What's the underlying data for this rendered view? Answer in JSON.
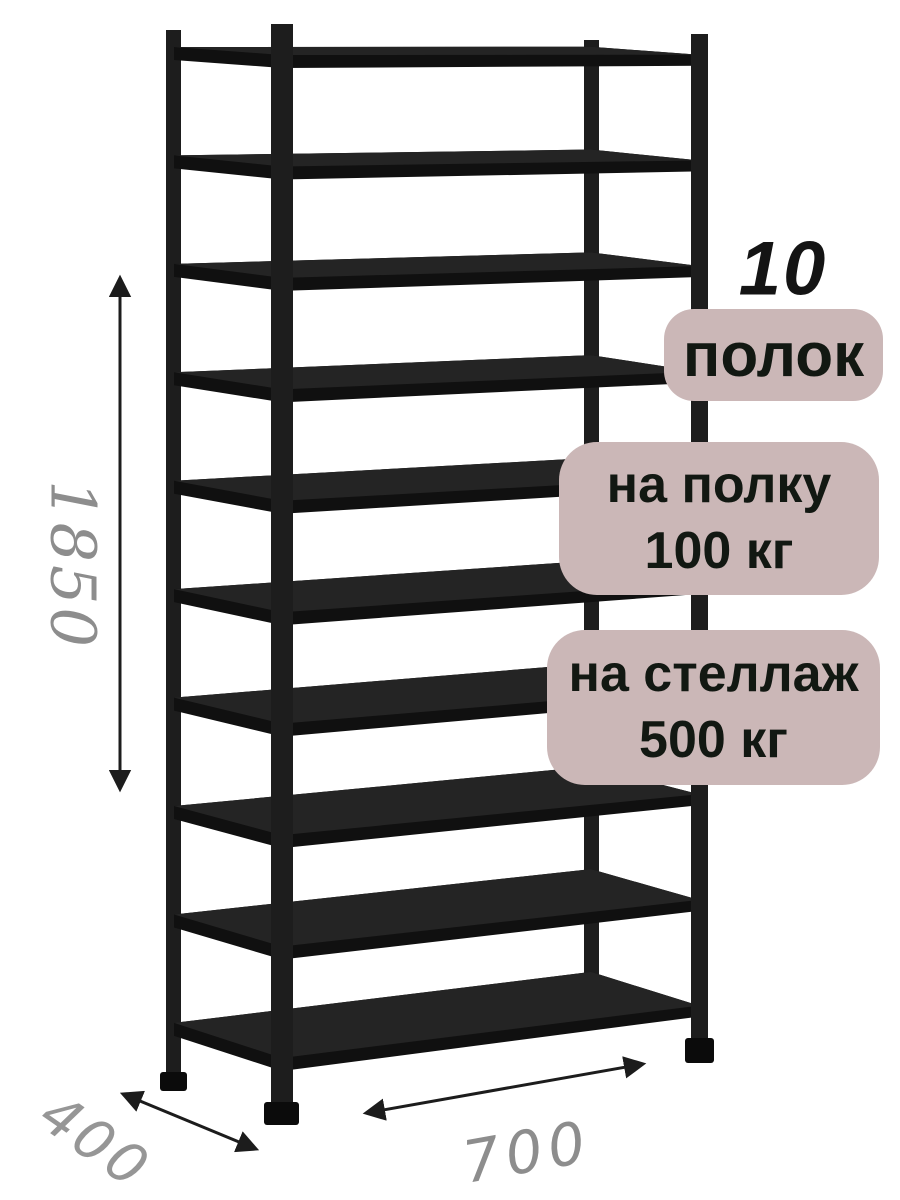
{
  "badges": {
    "shelf_count_number": "10",
    "shelf_count_word": "полок",
    "per_shelf_line1": "на полку",
    "per_shelf_line2": "100 кг",
    "per_rack_line1": "на стеллаж",
    "per_rack_line2": "500 кг"
  },
  "dimensions": {
    "height": "1850",
    "depth": "400",
    "width": "700"
  },
  "rack": {
    "shelf_count": 10
  },
  "colors": {
    "background": "#ffffff",
    "badge_bg": "#cbb7b7",
    "badge_text": "#121812",
    "rack_color": "#1a1a1a",
    "dimension_text": "#8d8d8d",
    "arrow_color": "#1c1c1c"
  }
}
